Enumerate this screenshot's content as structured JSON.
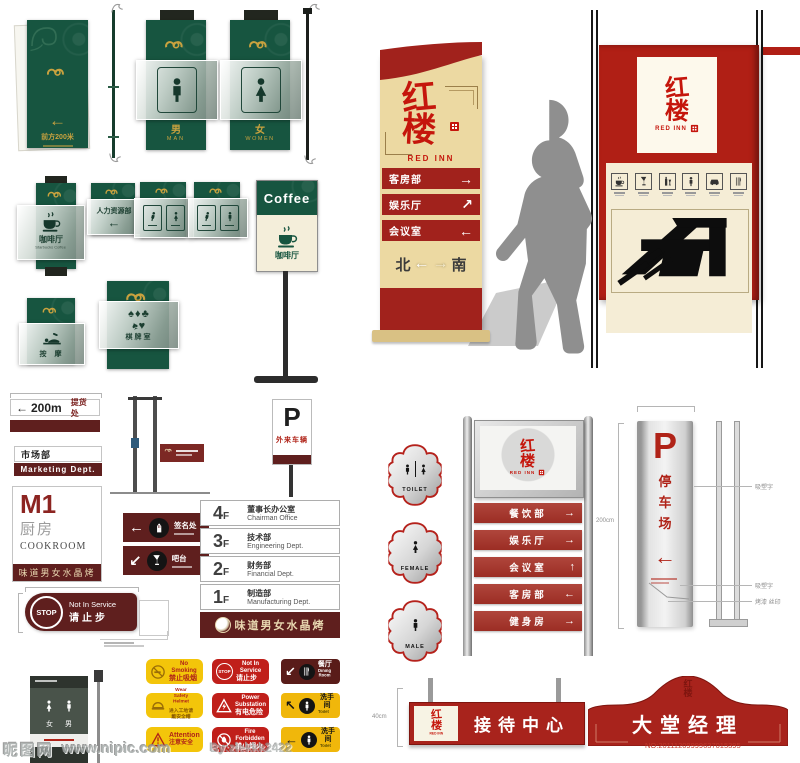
{
  "watermark": {
    "site": "昵图网",
    "url": "www.nipic.com",
    "credit": "By:zlekkk2422",
    "serial": "NO:20111209999637015395"
  },
  "brand": {
    "c1": "红",
    "c2": "楼",
    "en": "RED INN"
  },
  "green": {
    "direction_title": "前方200米",
    "male_cn": "男",
    "male_en": "MAN",
    "female_cn": "女",
    "female_en": "WOMEN",
    "coffee_cn": "咖啡厅",
    "coffee_en": "Starbucks Coffee",
    "coffee_head": "Coffee",
    "hr": "人力资源部",
    "hr_arrow": "←",
    "massage": "按 摩",
    "chess": "棋牌室"
  },
  "pylon": {
    "rows": [
      {
        "label": "客房部",
        "arrow": "→"
      },
      {
        "label": "娱乐厅",
        "arrow": "↗"
      },
      {
        "label": "会议室",
        "arrow": "←"
      }
    ],
    "north": "北",
    "south": "南",
    "left_arrow": "←",
    "right_arrow": "→"
  },
  "signs": {
    "pickup": {
      "arrow": "←",
      "dist": "200m",
      "dest": "提货处"
    },
    "marketing_cn": "市场部",
    "marketing_en": "Marketing Dept.",
    "m1": {
      "code": "M1",
      "cn": "厨房",
      "en": "COOKROOM",
      "brand": "味道男女水晶烤"
    },
    "visitor": {
      "code": "P",
      "label": "外来车辆"
    },
    "plaque1": {
      "arrow": "←",
      "label": "签名处"
    },
    "plaque2": {
      "arrow": "↙",
      "label": "吧台"
    },
    "stop": {
      "word": "STOP",
      "en": "Not In Service",
      "cn": "请止步"
    }
  },
  "directory": {
    "floors": [
      {
        "num": "4",
        "f": "F",
        "cn": "董事长办公室",
        "en": "Chairman Office"
      },
      {
        "num": "3",
        "f": "F",
        "cn": "技术部",
        "en": "Engineering Dept."
      },
      {
        "num": "2",
        "f": "F",
        "cn": "财务部",
        "en": "Financial Dept."
      },
      {
        "num": "1",
        "f": "F",
        "cn": "制造部",
        "en": "Manufacturing Dept."
      }
    ],
    "brand": "味道男女水晶烤"
  },
  "stand": {
    "rows": [
      {
        "label": "餐饮部",
        "arrow": "→"
      },
      {
        "label": "娱乐厅",
        "arrow": "→"
      },
      {
        "label": "会议室",
        "arrow": "↑"
      },
      {
        "label": "客房部",
        "arrow": "←"
      },
      {
        "label": "健身房",
        "arrow": "→"
      }
    ]
  },
  "restroom": {
    "toilet": "TOILET",
    "female": "FEMALE",
    "male": "MALE"
  },
  "parking": {
    "code": "P",
    "c1": "停",
    "c2": "车",
    "c3": "场",
    "arrow": "←",
    "dim": "200cm",
    "callout1": "吸塑字",
    "callout2": "吸塑字",
    "callout3": "烤漆 丝印"
  },
  "reception": {
    "label": "接待中心",
    "dim": "40cm"
  },
  "lobby": {
    "label": "大堂经理"
  },
  "safety": {
    "items": [
      {
        "l1": "No Smoking",
        "l2": "禁止吸烟"
      },
      {
        "l1": "Not In Service",
        "l2": "请止步"
      },
      {
        "arrow": "↙",
        "l1": "餐厅",
        "l2": "Dining Room"
      },
      {
        "l1": "Wear Safety Helmet",
        "l2": "进入工地请戴安全帽"
      },
      {
        "l1": "Power Substation",
        "l2": "有电危险"
      },
      {
        "arrow": "↖",
        "l1": "洗手间",
        "l2": "Toilet"
      },
      {
        "l1": "Attention",
        "l2": "注意安全"
      },
      {
        "l1": "Fire Forbidden",
        "l2": "禁止烟火"
      },
      {
        "arrow": "←",
        "l1": "洗手间",
        "l2": "Toilet"
      }
    ]
  },
  "service": {
    "female": "女",
    "male": "男"
  }
}
